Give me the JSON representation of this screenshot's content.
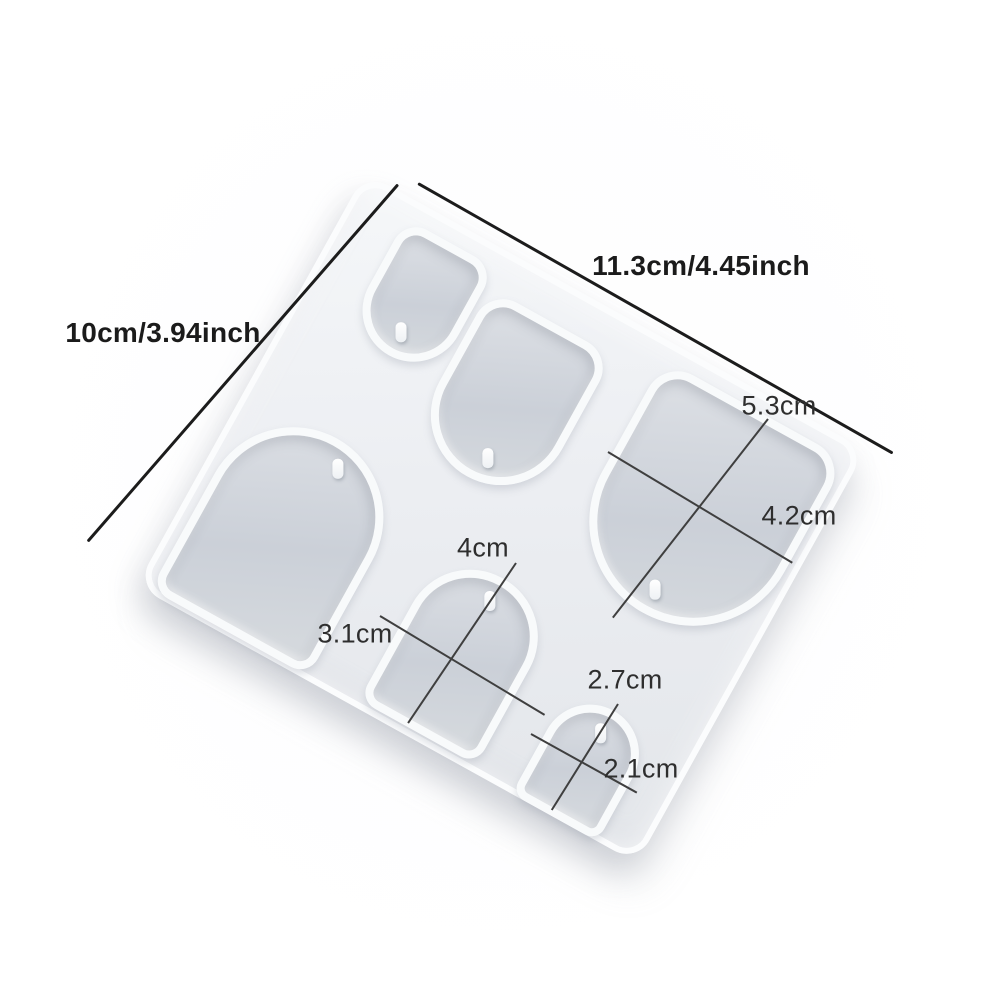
{
  "annotations": {
    "overall_width": "11.3cm/4.45inch",
    "overall_height": "10cm/3.94inch",
    "cavity_large": {
      "height": "5.3cm",
      "width": "4.2cm"
    },
    "cavity_medium": {
      "height": "4cm",
      "width": "3.1cm"
    },
    "cavity_small": {
      "height": "2.7cm",
      "width": "2.1cm"
    }
  },
  "colors": {
    "background": "#ffffff",
    "mold_surface": "#eef0f3",
    "mold_wall_highlight": "#f8fafb",
    "cavity_floor": "#ccd1d8",
    "dimension_line": "#1c1c1c",
    "cross_line": "#3f3f3f",
    "label_text": "#1b1b1b"
  }
}
